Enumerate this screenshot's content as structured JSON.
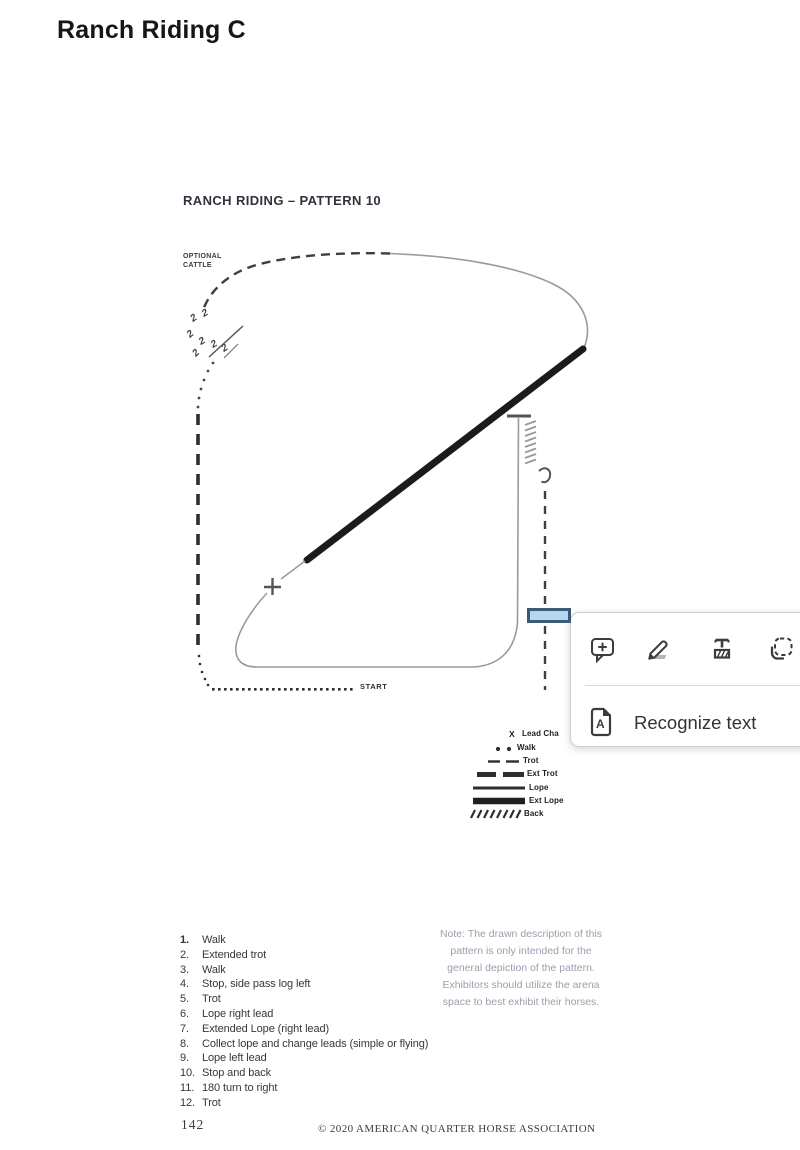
{
  "page": {
    "title": "Ranch Riding C"
  },
  "document": {
    "heading": "RANCH RIDING – PATTERN 10",
    "optional_cattle": {
      "line1": "OPTIONAL",
      "line2": "CATTLE"
    },
    "start_label": "START",
    "diagram": {
      "cattle_glyph": "2",
      "lead_change_marker": "+"
    },
    "legend": {
      "lead_change_symbol": "X",
      "items": [
        {
          "symbol": "lead-change",
          "label": "Lead Cha"
        },
        {
          "symbol": "walk",
          "label": "Walk"
        },
        {
          "symbol": "trot",
          "label": "Trot"
        },
        {
          "symbol": "ext-trot",
          "label": "Ext Trot"
        },
        {
          "symbol": "lope",
          "label": "Lope"
        },
        {
          "symbol": "ext-lope",
          "label": "Ext Lope"
        },
        {
          "symbol": "back",
          "label": "Back"
        }
      ]
    },
    "instructions": [
      {
        "num": "1.",
        "text": "Walk"
      },
      {
        "num": "2.",
        "text": "Extended trot"
      },
      {
        "num": "3.",
        "text": "Walk"
      },
      {
        "num": "4.",
        "text": "Stop, side pass log left"
      },
      {
        "num": "5.",
        "text": "Trot"
      },
      {
        "num": "6.",
        "text": "Lope right lead"
      },
      {
        "num": "7.",
        "text": "Extended Lope (right lead)"
      },
      {
        "num": "8.",
        "text": "Collect lope and change leads (simple or flying)"
      },
      {
        "num": "9.",
        "text": "Lope left lead"
      },
      {
        "num": "10.",
        "text": "Stop and back"
      },
      {
        "num": "11.",
        "text": "180 turn to right"
      },
      {
        "num": "12.",
        "text": "Trot"
      }
    ],
    "note": "Note: The drawn description of this pattern is only intended for the general depiction of the pattern. Exhibitors should utilize the arena space to best exhibit their horses.",
    "footer": {
      "page_number": "142",
      "copyright": "© 2020 AMERICAN QUARTER HORSE ASSOCIATION"
    }
  },
  "popup": {
    "tools": [
      {
        "icon": "add-comment-icon"
      },
      {
        "icon": "pencil-highlighter-icon"
      },
      {
        "icon": "highlight-text-icon"
      },
      {
        "icon": "area-select-icon"
      }
    ],
    "recognize": {
      "label": "Recognize text",
      "icon_letter": "A"
    }
  },
  "colors": {
    "selection_fill": "#b5d6ed",
    "selection_border": "#3d5a74",
    "icon_stroke": "#3c3c3c"
  }
}
